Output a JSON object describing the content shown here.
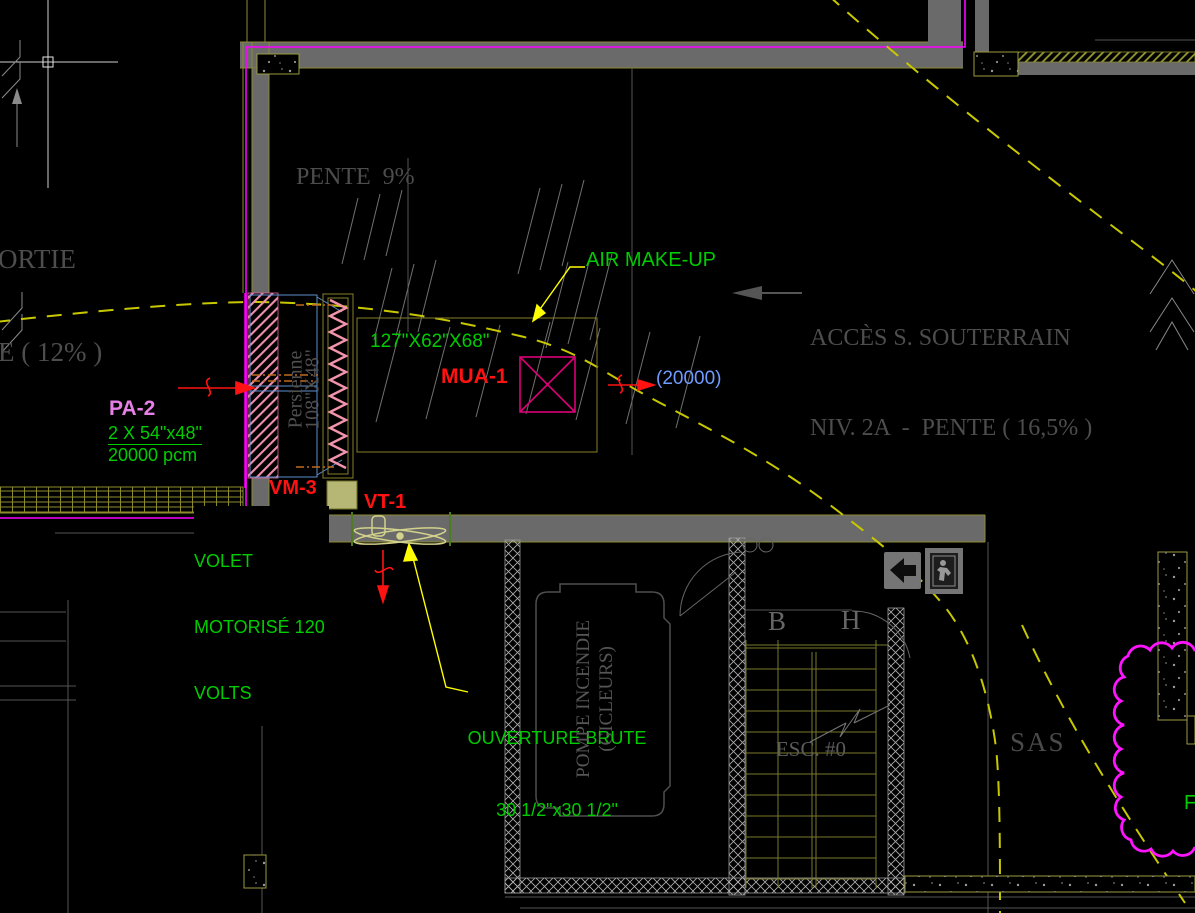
{
  "colors": {
    "background": "#000000",
    "wall_gray": "#6a6a6a",
    "line_olive": "#8b8b33",
    "annotation_green": "#00cc00",
    "tag_red": "#ff1212",
    "tag_pink": "#e680e6",
    "value_blue": "#6f9bff",
    "leader_yellow": "#ffff00",
    "dashed_path_yellow": "#c8c800",
    "revision_cloud_magenta": "#ff14ff",
    "wall_magenta_line": "#ff00ff",
    "room_text_gray": "#4d4d4d",
    "hatch_pink": "#ef8fae",
    "fan_khaki": "#d2d28c",
    "vm_square_fill": "#b6b675"
  },
  "labels": {
    "sortie_line1": "ORTIE",
    "sortie_line2": "E ( 12% )",
    "pente9": "PENTE  9%",
    "air_makeup": "AIR MAKE-UP",
    "acces_line1": "ACCÈS S. SOUTERRAIN",
    "acces_line2": "NIV. 2A  -  PENTE ( 16,5% )",
    "mua_size": "127\"X62\"X68\"",
    "mua_tag": "MUA-1",
    "mua_flow": "(20000)",
    "pa2_tag": "PA-2",
    "pa2_size": "2 X 54\"x48\"",
    "pa2_flow": "20000 pcm",
    "persienne_name": "Persienne",
    "persienne_size": "108\"X48\"",
    "vm3_tag": "VM-3",
    "vt1_tag": "VT-1",
    "volet_line1": "VOLET",
    "volet_line2": "MOTORISÉ 120",
    "volet_line3": "VOLTS",
    "ouverture_line1": "OUVERTURE BRUTE",
    "ouverture_line2": "30 1/2\"x30 1/2\"",
    "pompe_line1": "POMPE INCENDIE",
    "pompe_line2": "(GICLEURS)",
    "stair_b": "B",
    "stair_h": "H",
    "stair_esc": "ESC. #0",
    "sas": "SAS",
    "cloud_letter": "F"
  }
}
